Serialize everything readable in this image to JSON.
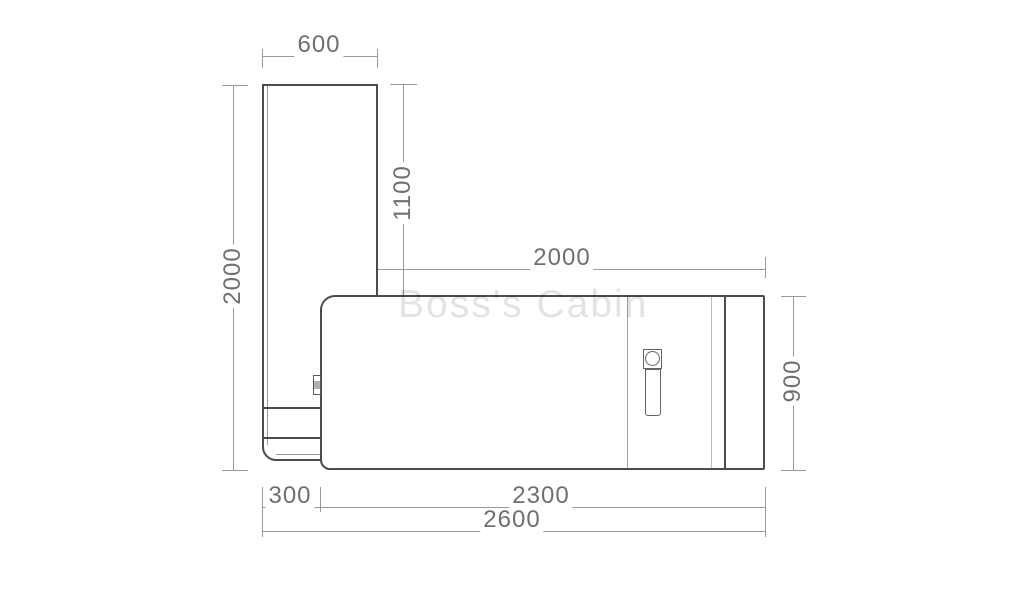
{
  "watermark": "Boss's Cabin",
  "drawing": {
    "type": "furniture plan view (L-shaped desk), dimensioned technical drawing",
    "dims": {
      "panel_width": "600",
      "upper_side": "1100",
      "desk_top_length": "2000",
      "total_depth": "2000",
      "desk_depth": "900",
      "bottom_offset": "300",
      "desk_bottom_length": "2300",
      "total_length": "2600"
    }
  },
  "colors": {
    "outline": "#4b4b4b",
    "dim_line": "#9a9a9a",
    "dim_text": "#6f6f6f",
    "watermark_text": "#e4e4e4",
    "background": "#ffffff"
  }
}
